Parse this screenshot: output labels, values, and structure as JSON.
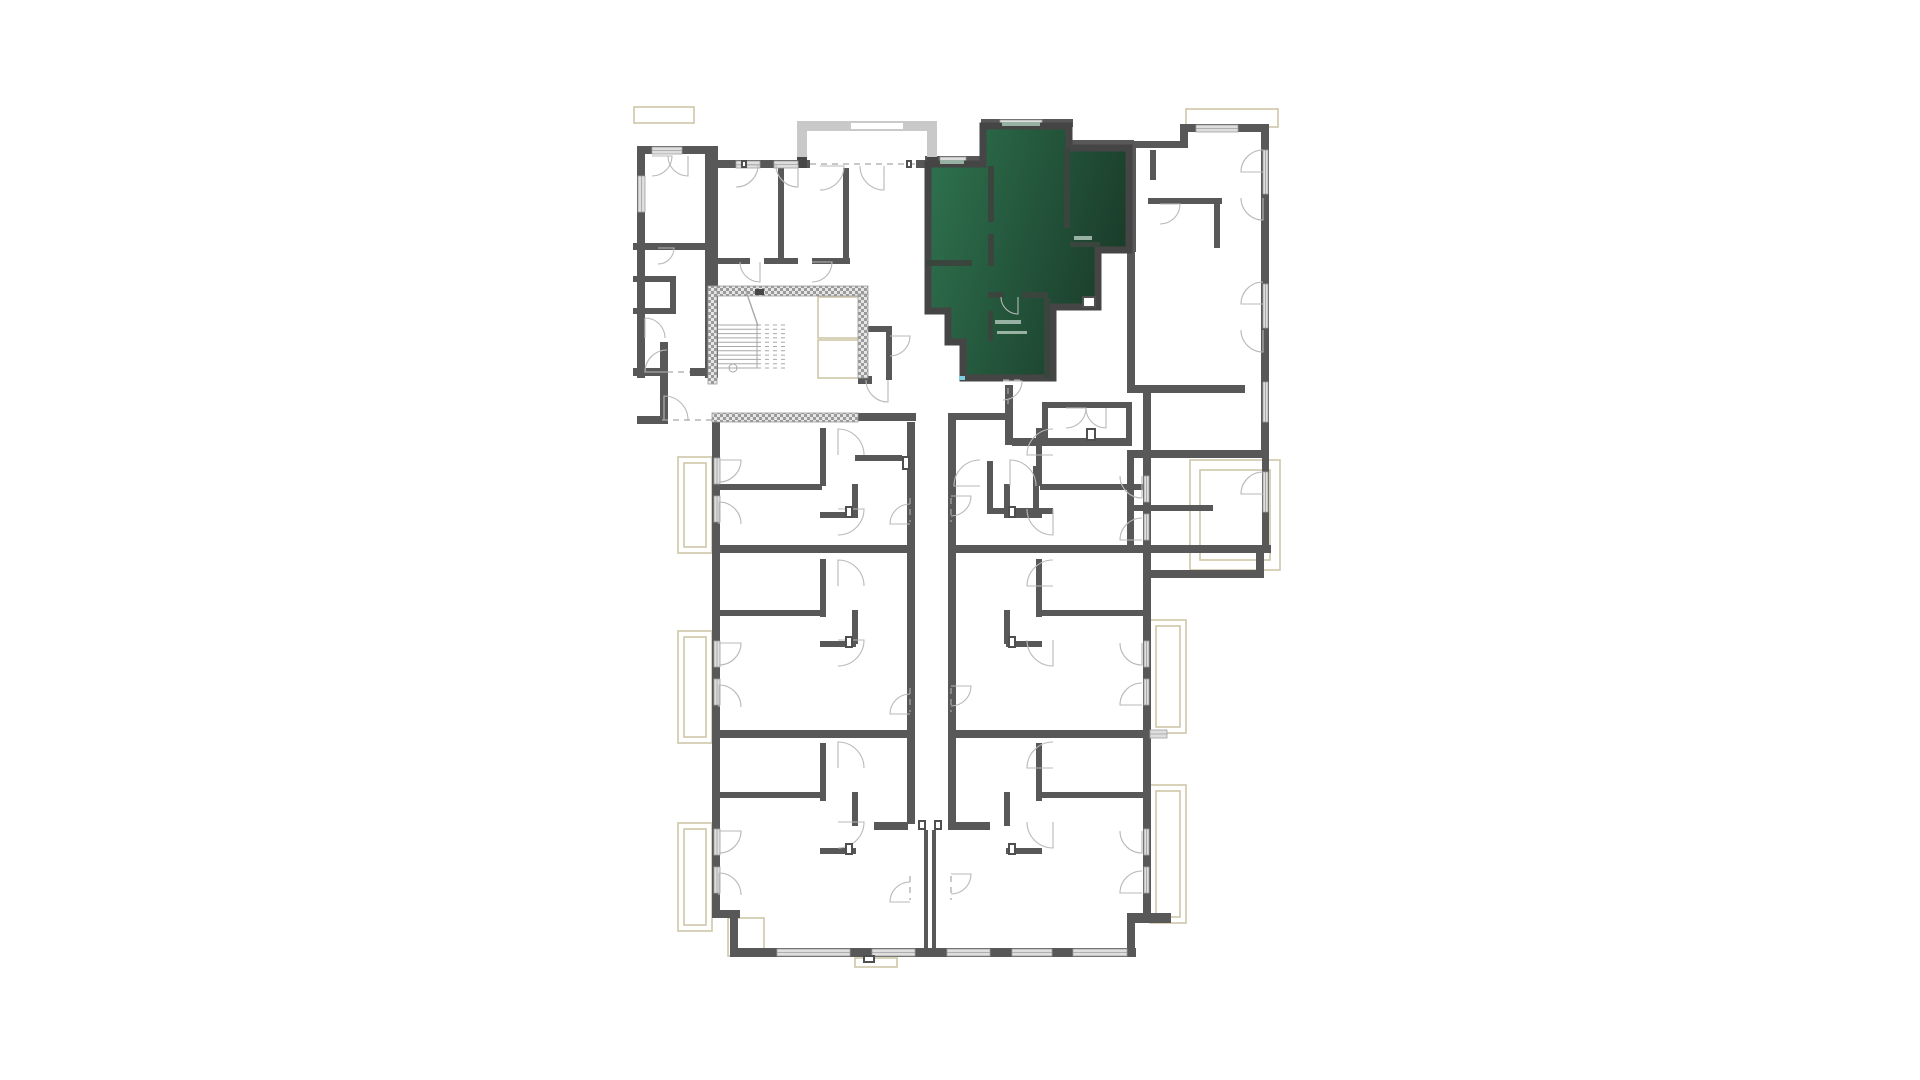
{
  "app": {
    "description": "architectural floor plan with one highlighted apartment unit",
    "background": "#ffffff"
  },
  "palette": {
    "wall": "#585858",
    "wall_dark": "#474747",
    "wall_light": "#c9c9c9",
    "window_fill": "#dedede",
    "window_edge": "#9f9f9f",
    "tan": "#cfc7a8",
    "tan_light": "#e2dcc6",
    "arc": "#b9b9b9",
    "dash": "#a6a6a6",
    "hatch_fg": "#9a9a9a",
    "hatch_bg": "#e6e6e6",
    "stair_line": "#a8a8a8",
    "green_from": "#2f7450",
    "green_to": "#1b3e2b",
    "green_wall": "#454545",
    "green_inner_wall": "#3a453d",
    "green_stub": "#97b2a2",
    "cyan": "#7ad0e0",
    "fixture": "#4f4f4f"
  },
  "highlight_unit": {
    "name": "selected-apartment",
    "path": "M928,164 L983,164 L983,126 L1069,126 L1069,148 L1129,148 L1129,250 L1098,250 L1098,307 L1053,307 L1053,378 L963,378 L963,342 L948,342 L948,311 L928,311 Z",
    "inner_walls": [
      [
        988,
        166,
        6,
        56
      ],
      [
        988,
        234,
        6,
        32
      ],
      [
        926,
        260,
        46,
        6
      ],
      [
        1064,
        148,
        6,
        80
      ],
      [
        1070,
        242,
        30,
        5
      ],
      [
        988,
        292,
        16,
        6
      ],
      [
        1022,
        292,
        26,
        6
      ],
      [
        1044,
        298,
        6,
        80
      ],
      [
        988,
        311,
        5,
        30
      ]
    ],
    "stubs": [
      [
        940,
        160,
        24,
        4
      ],
      [
        1002,
        122,
        38,
        4
      ],
      [
        995,
        320,
        26,
        4
      ],
      [
        997,
        331,
        30,
        3
      ],
      [
        1074,
        236,
        18,
        4
      ]
    ],
    "cyan_tick": [
      959,
      376,
      6,
      4
    ]
  },
  "plan": {
    "walls": [
      [
        637,
        146,
        8,
        232
      ],
      [
        637,
        146,
        75,
        8
      ],
      [
        705,
        146,
        13,
        232
      ],
      [
        718,
        160,
        92,
        8
      ],
      [
        916,
        160,
        19,
        8
      ],
      [
        925,
        156,
        62,
        8
      ],
      [
        981,
        119,
        9,
        46
      ],
      [
        981,
        119,
        92,
        8
      ],
      [
        1064,
        119,
        8,
        29
      ],
      [
        1064,
        140,
        70,
        8
      ],
      [
        1128,
        146,
        8,
        106
      ],
      [
        1134,
        141,
        48,
        7
      ],
      [
        1180,
        124,
        8,
        24
      ],
      [
        1180,
        124,
        88,
        8
      ],
      [
        1261,
        124,
        8,
        80
      ],
      [
        1261,
        196,
        8,
        262
      ],
      [
        1127,
        450,
        141,
        8
      ],
      [
        1127,
        458,
        7,
        95
      ],
      [
        1127,
        545,
        144,
        8
      ],
      [
        1262,
        458,
        7,
        95
      ],
      [
        1256,
        553,
        8,
        24
      ],
      [
        1150,
        570,
        114,
        8
      ],
      [
        633,
        368,
        35,
        8
      ],
      [
        690,
        368,
        28,
        8
      ],
      [
        660,
        342,
        8,
        82
      ],
      [
        637,
        416,
        24,
        8
      ],
      [
        858,
        413,
        58,
        8
      ],
      [
        948,
        413,
        58,
        7
      ],
      [
        1005,
        385,
        8,
        60
      ],
      [
        1012,
        438,
        120,
        8
      ],
      [
        1127,
        252,
        8,
        141
      ],
      [
        1135,
        385,
        110,
        8
      ],
      [
        1042,
        402,
        90,
        6
      ],
      [
        1042,
        402,
        6,
        44
      ],
      [
        1126,
        402,
        6,
        44
      ],
      [
        778,
        168,
        6,
        96
      ],
      [
        843,
        168,
        6,
        96
      ],
      [
        718,
        258,
        32,
        6
      ],
      [
        764,
        258,
        34,
        6
      ],
      [
        812,
        258,
        38,
        6
      ],
      [
        862,
        326,
        30,
        6
      ],
      [
        886,
        332,
        6,
        48
      ],
      [
        633,
        243,
        76,
        7
      ],
      [
        670,
        276,
        6,
        38
      ],
      [
        633,
        276,
        42,
        6
      ],
      [
        633,
        308,
        42,
        6
      ],
      [
        1150,
        150,
        6,
        30
      ],
      [
        1148,
        198,
        74,
        6
      ],
      [
        1214,
        204,
        6,
        44
      ],
      [
        1133,
        505,
        80,
        6
      ],
      [
        858,
        376,
        14,
        8
      ],
      [
        712,
        422,
        8,
        496
      ],
      [
        712,
        910,
        28,
        8
      ],
      [
        730,
        917,
        8,
        40
      ],
      [
        730,
        948,
        406,
        9
      ],
      [
        1127,
        913,
        44,
        10
      ],
      [
        1127,
        923,
        8,
        28
      ],
      [
        1143,
        392,
        8,
        529
      ],
      [
        712,
        545,
        203,
        8
      ],
      [
        712,
        730,
        203,
        8
      ],
      [
        948,
        545,
        203,
        8
      ],
      [
        948,
        730,
        203,
        8
      ],
      [
        907,
        422,
        8,
        402
      ],
      [
        948,
        420,
        8,
        404
      ],
      [
        874,
        822,
        34,
        8
      ],
      [
        948,
        822,
        42,
        8
      ],
      [
        924,
        830,
        4,
        120
      ],
      [
        932,
        830,
        4,
        120
      ],
      [
        855,
        455,
        47,
        6
      ],
      [
        718,
        484,
        104,
        6
      ],
      [
        820,
        428,
        6,
        58
      ],
      [
        820,
        512,
        36,
        6
      ],
      [
        852,
        484,
        6,
        34
      ],
      [
        718,
        610,
        104,
        6
      ],
      [
        820,
        559,
        6,
        58
      ],
      [
        820,
        641,
        36,
        6
      ],
      [
        852,
        610,
        6,
        34
      ],
      [
        718,
        792,
        104,
        6
      ],
      [
        820,
        743,
        6,
        58
      ],
      [
        820,
        848,
        36,
        6
      ],
      [
        852,
        792,
        6,
        34
      ],
      [
        1040,
        484,
        104,
        6
      ],
      [
        1036,
        428,
        6,
        58
      ],
      [
        1006,
        512,
        36,
        6
      ],
      [
        1004,
        484,
        6,
        34
      ],
      [
        1040,
        610,
        104,
        6
      ],
      [
        1036,
        559,
        6,
        58
      ],
      [
        1006,
        641,
        36,
        6
      ],
      [
        1004,
        610,
        6,
        34
      ],
      [
        1040,
        792,
        104,
        6
      ],
      [
        1036,
        743,
        6,
        58
      ],
      [
        1006,
        848,
        36,
        6
      ],
      [
        1004,
        792,
        6,
        34
      ],
      [
        987,
        461,
        6,
        52
      ],
      [
        987,
        508,
        66,
        6
      ],
      [
        1033,
        466,
        6,
        46
      ]
    ],
    "hatch_walls": [
      [
        712,
        286,
        156,
        10
      ],
      [
        708,
        286,
        9,
        98
      ],
      [
        858,
        294,
        10,
        84
      ],
      [
        712,
        413,
        146,
        9
      ]
    ],
    "balcony_center": {
      "light": [
        [
          797,
          121,
          140,
          10
        ],
        [
          797,
          121,
          10,
          47
        ],
        [
          927,
          121,
          10,
          47
        ]
      ],
      "white": [
        [
          851,
          123,
          52,
          6
        ]
      ],
      "dark": [
        [
          797,
          157,
          10,
          11
        ],
        [
          927,
          157,
          11,
          11
        ]
      ]
    },
    "windows": [
      [
        652,
        147,
        30,
        7
      ],
      [
        638,
        176,
        7,
        36
      ],
      [
        736,
        161,
        24,
        7
      ],
      [
        774,
        161,
        24,
        7
      ],
      [
        940,
        157,
        26,
        7
      ],
      [
        1000,
        120,
        42,
        7
      ],
      [
        1040,
        157,
        28,
        8
      ],
      [
        1196,
        125,
        42,
        7
      ],
      [
        1263,
        150,
        5,
        44
      ],
      [
        1263,
        284,
        5,
        44
      ],
      [
        1263,
        382,
        5,
        40
      ],
      [
        1263,
        472,
        5,
        40
      ],
      [
        714,
        458,
        6,
        26
      ],
      [
        714,
        496,
        6,
        26
      ],
      [
        714,
        641,
        6,
        26
      ],
      [
        714,
        679,
        6,
        26
      ],
      [
        714,
        829,
        6,
        26
      ],
      [
        714,
        867,
        6,
        26
      ],
      [
        777,
        949,
        73,
        7
      ],
      [
        872,
        949,
        43,
        7
      ],
      [
        947,
        949,
        43,
        7
      ],
      [
        1012,
        949,
        40,
        7
      ],
      [
        1073,
        949,
        54,
        7
      ],
      [
        1144,
        476,
        5,
        26
      ],
      [
        1144,
        514,
        5,
        26
      ],
      [
        1144,
        641,
        5,
        26
      ],
      [
        1144,
        679,
        5,
        26
      ],
      [
        1144,
        829,
        5,
        26
      ],
      [
        1144,
        867,
        5,
        26
      ],
      [
        1150,
        730,
        17,
        8
      ]
    ],
    "tan_rects": [
      [
        634,
        107,
        60,
        16
      ],
      [
        1186,
        109,
        92,
        18
      ],
      [
        678,
        457,
        34,
        96
      ],
      [
        678,
        631,
        34,
        112
      ],
      [
        678,
        823,
        34,
        108
      ],
      [
        1150,
        620,
        36,
        113
      ],
      [
        1150,
        785,
        36,
        138
      ],
      [
        1190,
        460,
        90,
        110
      ],
      [
        1200,
        470,
        70,
        90
      ],
      [
        728,
        918,
        36,
        38
      ],
      [
        818,
        297,
        45,
        41
      ],
      [
        818,
        340,
        45,
        38
      ],
      [
        855,
        958,
        42,
        9
      ],
      [
        684,
        463,
        22,
        84
      ],
      [
        684,
        637,
        22,
        100
      ],
      [
        684,
        829,
        22,
        96
      ],
      [
        1156,
        626,
        24,
        101
      ],
      [
        1156,
        791,
        24,
        126
      ]
    ],
    "dashed": [
      [
        667,
        372,
        690,
        372
      ],
      [
        662,
        420,
        712,
        420
      ],
      [
        810,
        164,
        916,
        164
      ],
      [
        1003,
        380,
        1021,
        380
      ],
      [
        1008,
        388,
        1008,
        404
      ],
      [
        910,
        498,
        910,
        522
      ],
      [
        910,
        688,
        910,
        712
      ],
      [
        910,
        876,
        910,
        900
      ],
      [
        951,
        498,
        951,
        522
      ],
      [
        951,
        688,
        951,
        712
      ],
      [
        951,
        876,
        951,
        900
      ]
    ],
    "doors": [
      [
        667,
        372,
        22,
        180,
        270
      ],
      [
        664,
        420,
        24,
        270,
        360
      ],
      [
        820,
        166,
        24,
        0,
        90
      ],
      [
        884,
        166,
        24,
        90,
        180
      ],
      [
        736,
        165,
        22,
        0,
        90
      ],
      [
        798,
        165,
        22,
        90,
        180
      ],
      [
        652,
        156,
        20,
        0,
        90
      ],
      [
        688,
        156,
        20,
        90,
        180
      ],
      [
        658,
        248,
        16,
        0,
        90
      ],
      [
        645,
        338,
        20,
        270,
        360
      ],
      [
        760,
        262,
        20,
        90,
        180
      ],
      [
        812,
        262,
        20,
        0,
        90
      ],
      [
        890,
        336,
        20,
        0,
        90
      ],
      [
        888,
        380,
        22,
        90,
        180
      ],
      [
        1003,
        381,
        19,
        0,
        90
      ],
      [
        1018,
        297,
        17,
        90,
        180
      ],
      [
        1160,
        204,
        20,
        0,
        90
      ],
      [
        1263,
        172,
        22,
        180,
        270
      ],
      [
        1263,
        198,
        22,
        90,
        180
      ],
      [
        1263,
        304,
        22,
        180,
        270
      ],
      [
        1263,
        330,
        22,
        90,
        180
      ],
      [
        1263,
        494,
        22,
        180,
        270
      ],
      [
        980,
        486,
        26,
        180,
        270
      ],
      [
        1010,
        486,
        26,
        270,
        360
      ],
      [
        1066,
        408,
        20,
        0,
        90
      ],
      [
        1106,
        408,
        20,
        90,
        180
      ],
      [
        910,
        524,
        20,
        180,
        270
      ],
      [
        910,
        714,
        20,
        180,
        270
      ],
      [
        910,
        902,
        20,
        180,
        270
      ],
      [
        951,
        496,
        20,
        0,
        90
      ],
      [
        951,
        686,
        20,
        0,
        90
      ],
      [
        951,
        874,
        20,
        0,
        90
      ],
      [
        719,
        460,
        22,
        0,
        90
      ],
      [
        719,
        524,
        22,
        270,
        360
      ],
      [
        719,
        643,
        22,
        0,
        90
      ],
      [
        719,
        707,
        22,
        270,
        360
      ],
      [
        719,
        831,
        22,
        0,
        90
      ],
      [
        719,
        895,
        22,
        270,
        360
      ],
      [
        1142,
        476,
        22,
        90,
        180
      ],
      [
        1142,
        540,
        22,
        180,
        270
      ],
      [
        1142,
        643,
        22,
        90,
        180
      ],
      [
        1142,
        705,
        22,
        180,
        270
      ],
      [
        1142,
        831,
        22,
        90,
        180
      ],
      [
        1142,
        893,
        22,
        180,
        270
      ],
      [
        838,
        455,
        26,
        270,
        360
      ],
      [
        838,
        509,
        26,
        0,
        90
      ],
      [
        838,
        586,
        26,
        270,
        360
      ],
      [
        838,
        640,
        26,
        0,
        90
      ],
      [
        838,
        768,
        26,
        270,
        360
      ],
      [
        838,
        822,
        26,
        0,
        90
      ],
      [
        1053,
        455,
        26,
        180,
        270
      ],
      [
        1053,
        509,
        26,
        90,
        180
      ],
      [
        1053,
        586,
        26,
        180,
        270
      ],
      [
        1053,
        640,
        26,
        90,
        180
      ],
      [
        1053,
        768,
        26,
        180,
        270
      ],
      [
        1053,
        822,
        26,
        90,
        180
      ]
    ],
    "stairs": {
      "x": 718,
      "y": 325,
      "w_solid": 39,
      "w_dash": 29,
      "n": 11,
      "dy": 4.3,
      "rail_x": 757,
      "edge_x": 786,
      "arrow": [
        746,
        291,
        758,
        326
      ],
      "arrow_block": [
        755,
        289,
        9,
        6
      ],
      "circle": [
        733,
        368,
        4
      ]
    },
    "fixtures": [
      [
        1082,
        296,
        14,
        12
      ],
      [
        902,
        456,
        8,
        14
      ],
      [
        1086,
        428,
        10,
        13
      ],
      [
        918,
        820,
        8,
        10
      ],
      [
        934,
        820,
        8,
        10
      ],
      [
        845,
        506,
        8,
        12
      ],
      [
        845,
        636,
        8,
        12
      ],
      [
        845,
        843,
        8,
        12
      ],
      [
        1008,
        506,
        8,
        12
      ],
      [
        1008,
        636,
        8,
        12
      ],
      [
        1008,
        843,
        8,
        12
      ],
      [
        863,
        955,
        12,
        8
      ],
      [
        741,
        160,
        6,
        8
      ],
      [
        906,
        160,
        6,
        8
      ]
    ]
  }
}
